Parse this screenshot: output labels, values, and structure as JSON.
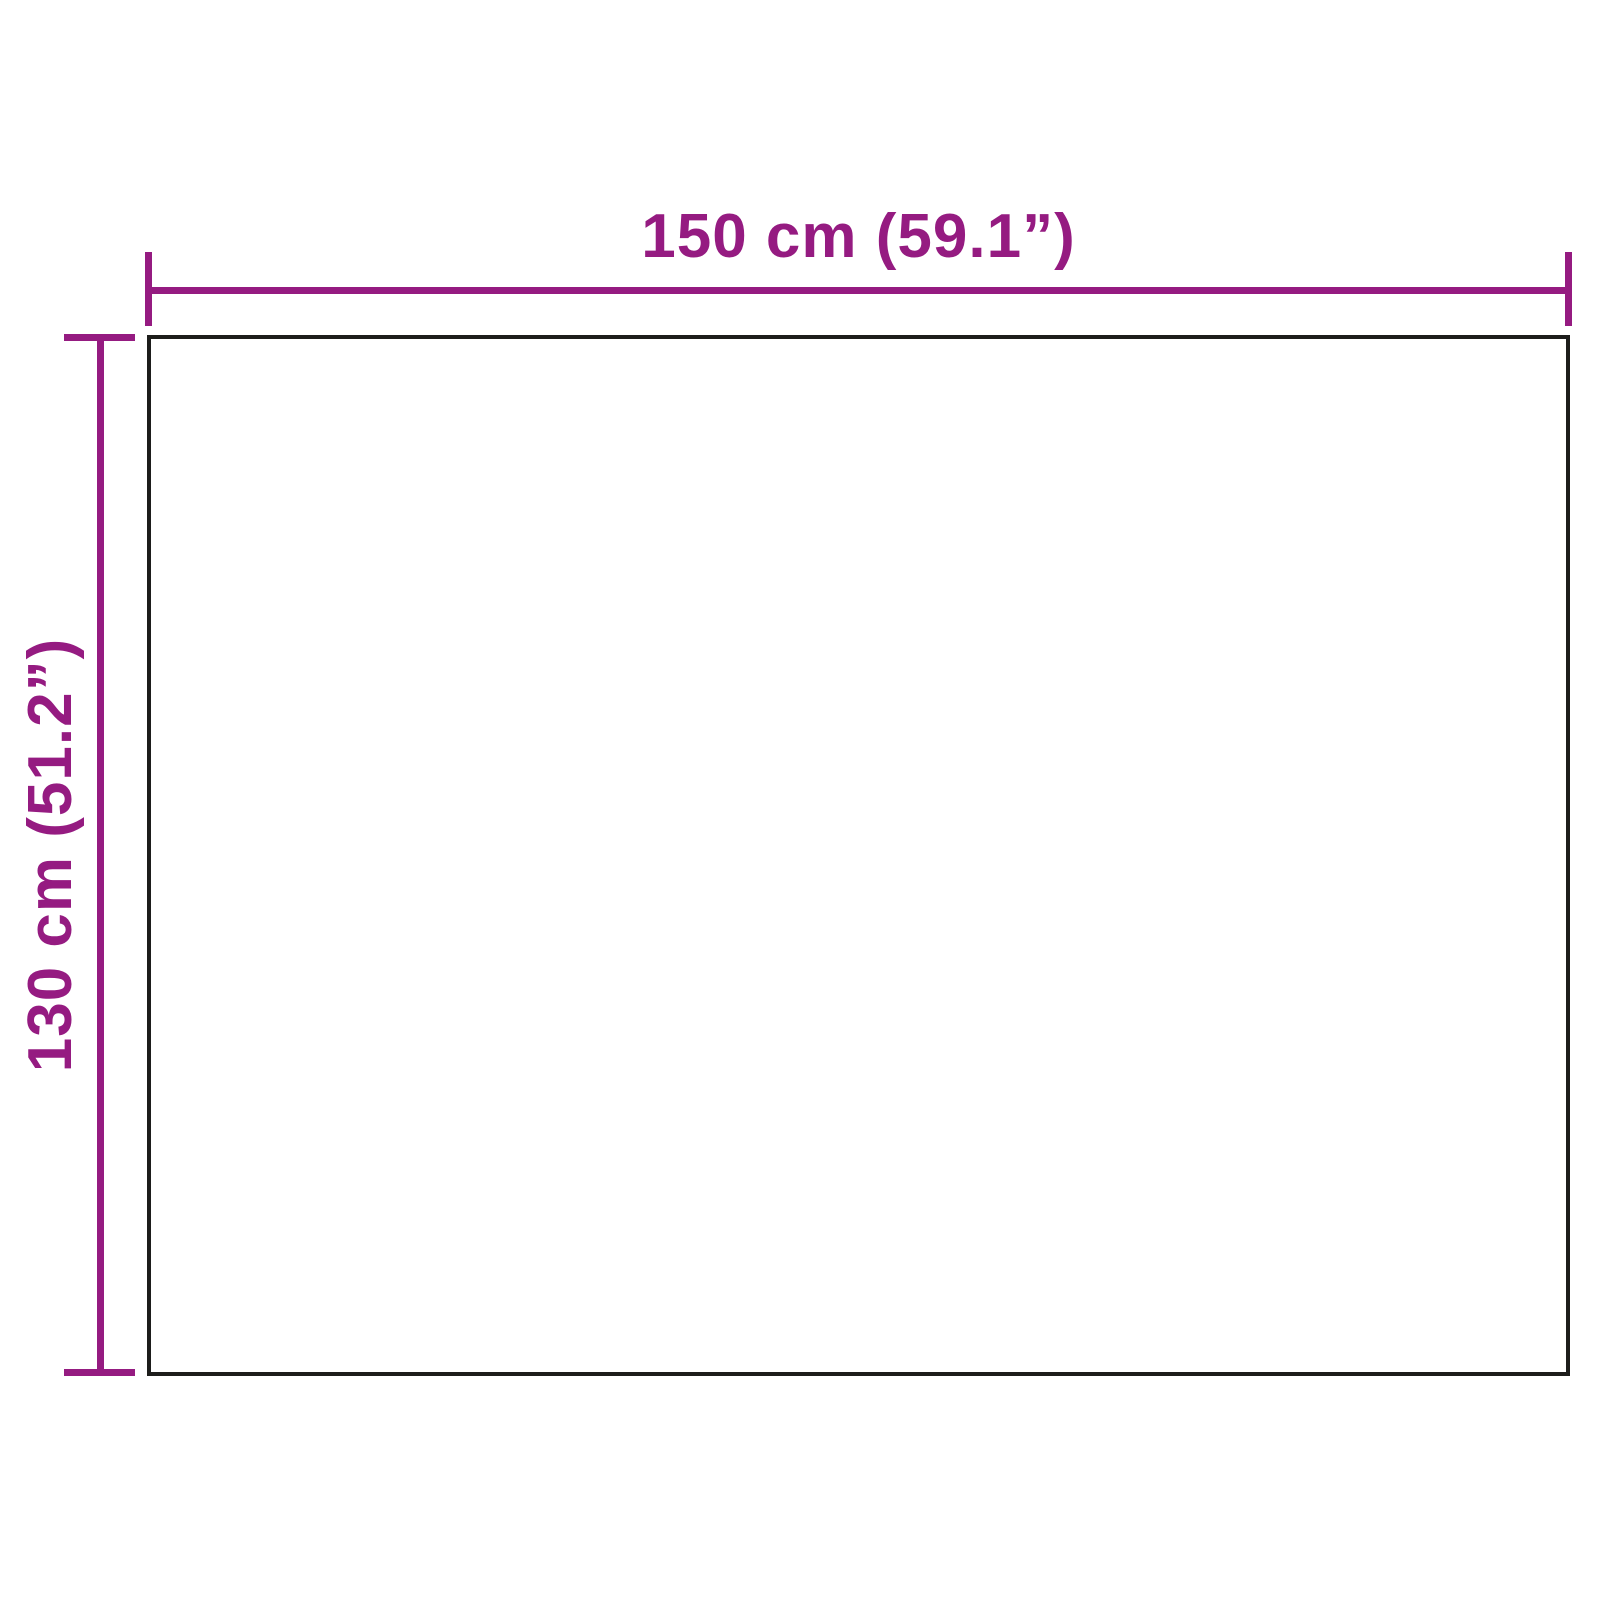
{
  "diagram": {
    "type": "product-dimension-diagram",
    "width_label": "150 cm (59.1”)",
    "height_label": "130 cm (51.2”)",
    "width_value_cm": 150,
    "width_value_in": 59.1,
    "height_value_cm": 130,
    "height_value_in": 51.2,
    "colors": {
      "dimension": "#951b81",
      "outline": "#1d1d1b",
      "background": "#ffffff"
    }
  }
}
